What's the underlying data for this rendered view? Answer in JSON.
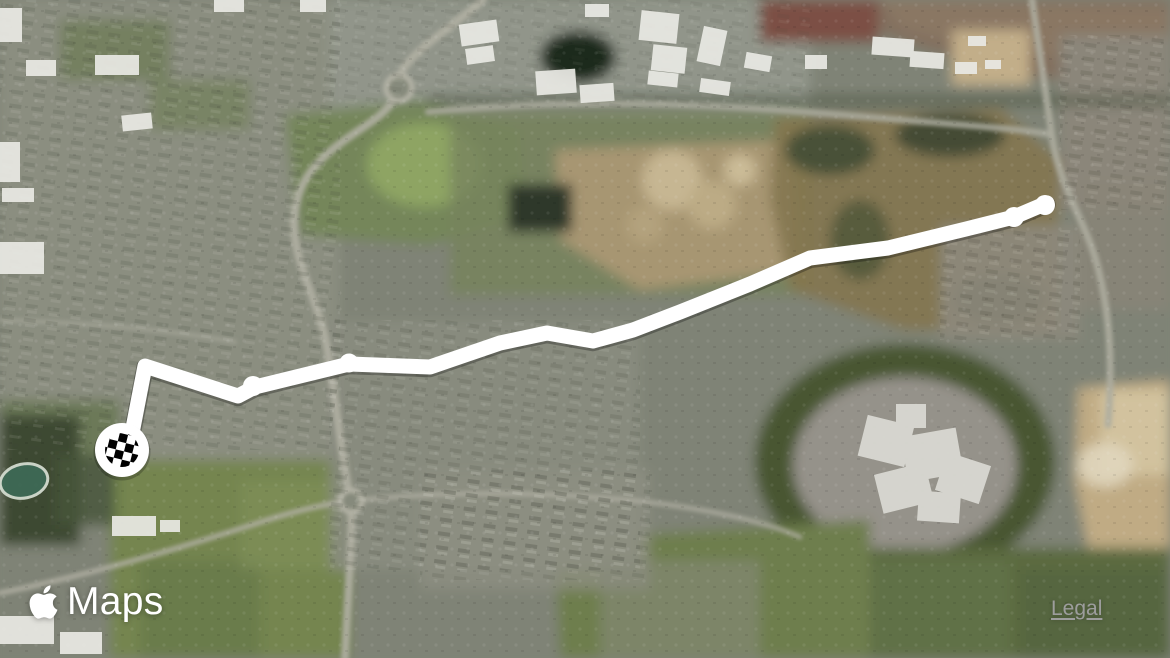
{
  "window": {
    "width": 1170,
    "height": 658
  },
  "branding": {
    "logo_icon": "apple-icon",
    "logo_text": "Maps"
  },
  "legal": {
    "label": "Legal",
    "color": "#9d9d9d"
  },
  "map": {
    "view_mode": "satellite",
    "route": {
      "color": "#ffffff",
      "shadow_color": "rgba(0,0,0,0.28)",
      "stroke_width": 15,
      "points": [
        [
          1047,
          203
        ],
        [
          1014,
          217
        ],
        [
          966,
          229
        ],
        [
          888,
          248
        ],
        [
          810,
          258
        ],
        [
          750,
          284
        ],
        [
          680,
          312
        ],
        [
          633,
          330
        ],
        [
          593,
          341
        ],
        [
          547,
          333
        ],
        [
          500,
          343
        ],
        [
          430,
          367
        ],
        [
          349,
          364
        ],
        [
          255,
          387
        ],
        [
          238,
          396
        ],
        [
          145,
          366
        ],
        [
          133,
          428
        ],
        [
          126,
          442
        ]
      ],
      "node_points": [
        [
          1045,
          205,
          10
        ],
        [
          1014,
          217,
          10
        ],
        [
          349,
          363,
          9.5
        ],
        [
          253,
          386,
          10
        ]
      ],
      "end_marker": {
        "type": "finish-checkered-flag",
        "x": 122,
        "y": 450,
        "outer_radius": 27,
        "ball_radius": 17,
        "outer_color": "#ffffff",
        "checker_color": "#000000"
      }
    }
  }
}
